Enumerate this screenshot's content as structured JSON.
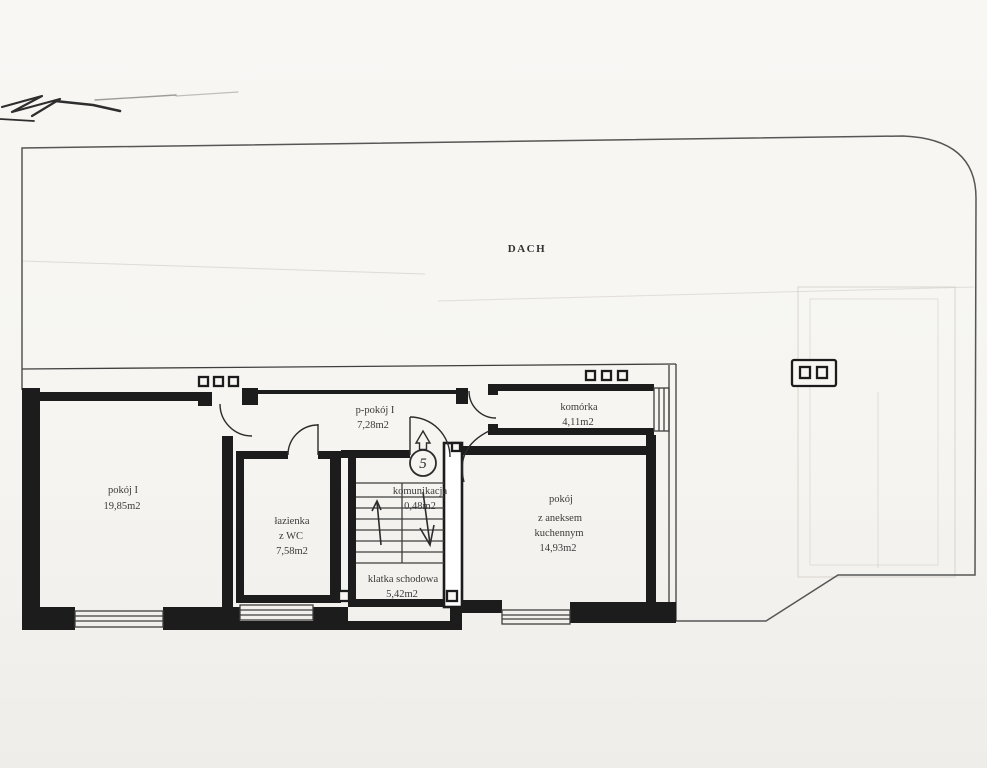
{
  "roof": {
    "label": "DACH"
  },
  "rooms": {
    "pokoj1": {
      "name": "pokój I",
      "area": "19,85m2"
    },
    "lazienka": {
      "line1": "łazienka",
      "line2": "z WC",
      "area": "7,58m2"
    },
    "ppokoj": {
      "name": "p-pokój I",
      "area": "7,28m2"
    },
    "komunikacja": {
      "name": "komunikacja",
      "area": "0,48m2"
    },
    "klatka": {
      "name": "klatka schodowa",
      "area": "5,42m2"
    },
    "komorka": {
      "name": "komórka",
      "area": "4,11m2"
    },
    "pokojAneks": {
      "line1": "pokój",
      "line2": "z aneksem",
      "line3": "kuchennym",
      "area": "14,93m2"
    }
  },
  "unit": {
    "number": "5"
  },
  "colors": {
    "paper": "#f6f5f1",
    "wall": "#1c1c1c",
    "line": "#3f3f3f",
    "text": "#3a3a3a"
  }
}
